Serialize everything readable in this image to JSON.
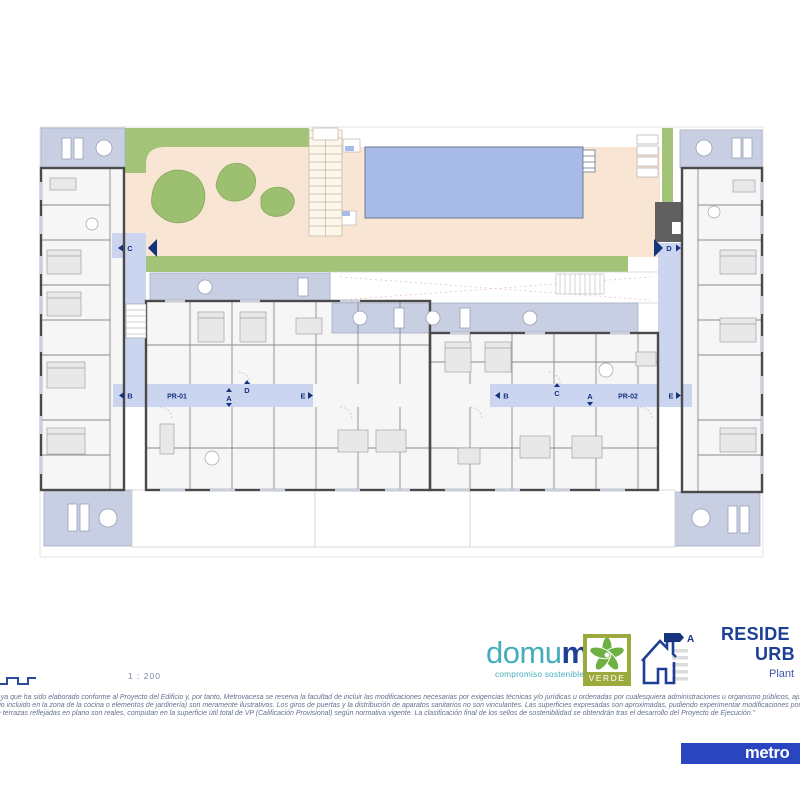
{
  "footer": {
    "scale_label": "1 : 200",
    "disclaimer_lines": [
      "o, ya que ha sido elaborado conforme al Proyecto del Edificio y, por tanto, Metrovacesa se reserva la facultad de incluir las modificaciones necesarias por exigencias técnicas y/o jurídicas u ordenadas por cualesquiera administraciones u organismo públicos, ajustándolos en todo caso al Proyecto de",
      "ario incluido en la zona de la cocina o elementos de jardinería) son meramente ilustrativos. Los giros de puertas y la distribución de aparatos sanitarios no son vinculantes. Las superficies expresadas son aproximadas, pudiendo experimentar modificaciones por razones de índole técnico y/o legal e",
      "de terrazas reflejadas en plano son reales, computan en la superficie útil total de VP (Calificación Provisional) según normativa vigente. La clasificación final de los sellos de sostenibilidad se obtendrán tras el desarrollo del Proyecto de Ejecución.\""
    ],
    "domum": {
      "name_head": "domu",
      "name_tail": "m",
      "tagline": "compromiso sostenible"
    },
    "verde": {
      "label": "VERDE"
    },
    "energy": {
      "rating": "A"
    },
    "title": {
      "line1": "RESIDE",
      "line2": "URB",
      "line3": "Plant"
    },
    "metrovacesa": {
      "wordmark": "metro"
    }
  },
  "plan": {
    "section_markers": {
      "left_c": "C",
      "right_d": "D"
    },
    "left_corridor": {
      "b": "B",
      "pr": "PR-01",
      "a": "A",
      "d": "D",
      "e": "E"
    },
    "right_corridor": {
      "b": "B",
      "c": "C",
      "a": "A",
      "pr": "PR-02",
      "e": "E"
    }
  },
  "colors": {
    "navy": "#16337e",
    "teal": "#45adbb",
    "olive": "#9ca93c",
    "pool": "#a8bbe6",
    "grass": "#a3c379",
    "patio": "#f8e5d3",
    "terrace": "#c9cfe2",
    "corridor": "#ccd5ef",
    "metro_blue": "#2946c0"
  }
}
